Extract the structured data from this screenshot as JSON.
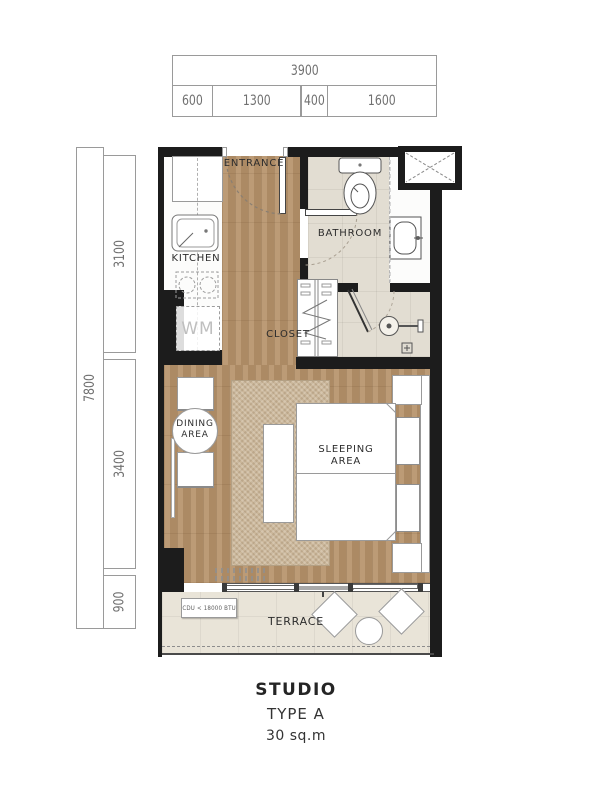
{
  "dimensions": {
    "top": {
      "total": "3900",
      "segments": [
        "600",
        "1300",
        "400",
        "1600"
      ]
    },
    "left": {
      "total": "7800",
      "segments": [
        "3100",
        "3400",
        "900"
      ]
    }
  },
  "plan": {
    "labels": {
      "entrance": "ENTRANCE",
      "kitchen": "KITCHEN",
      "bathroom": "BATHROOM",
      "closet": "CLOSET",
      "wm": "WM",
      "dining": [
        "DINING",
        "AREA"
      ],
      "sleeping": [
        "SLEEPING",
        "AREA"
      ],
      "terrace": "TERRACE",
      "cdu": "CDU < 18000 BTU"
    }
  },
  "title": {
    "name": "STUDIO",
    "type": "TYPE A",
    "area": "30 sq.m"
  },
  "colors": {
    "wall": "#1c1c1c",
    "wood_floor": "#b4916a",
    "bathroom_tile": "#e2ddd2",
    "terrace_tile": "#e9e4d8",
    "rug": "#cbb79b"
  }
}
